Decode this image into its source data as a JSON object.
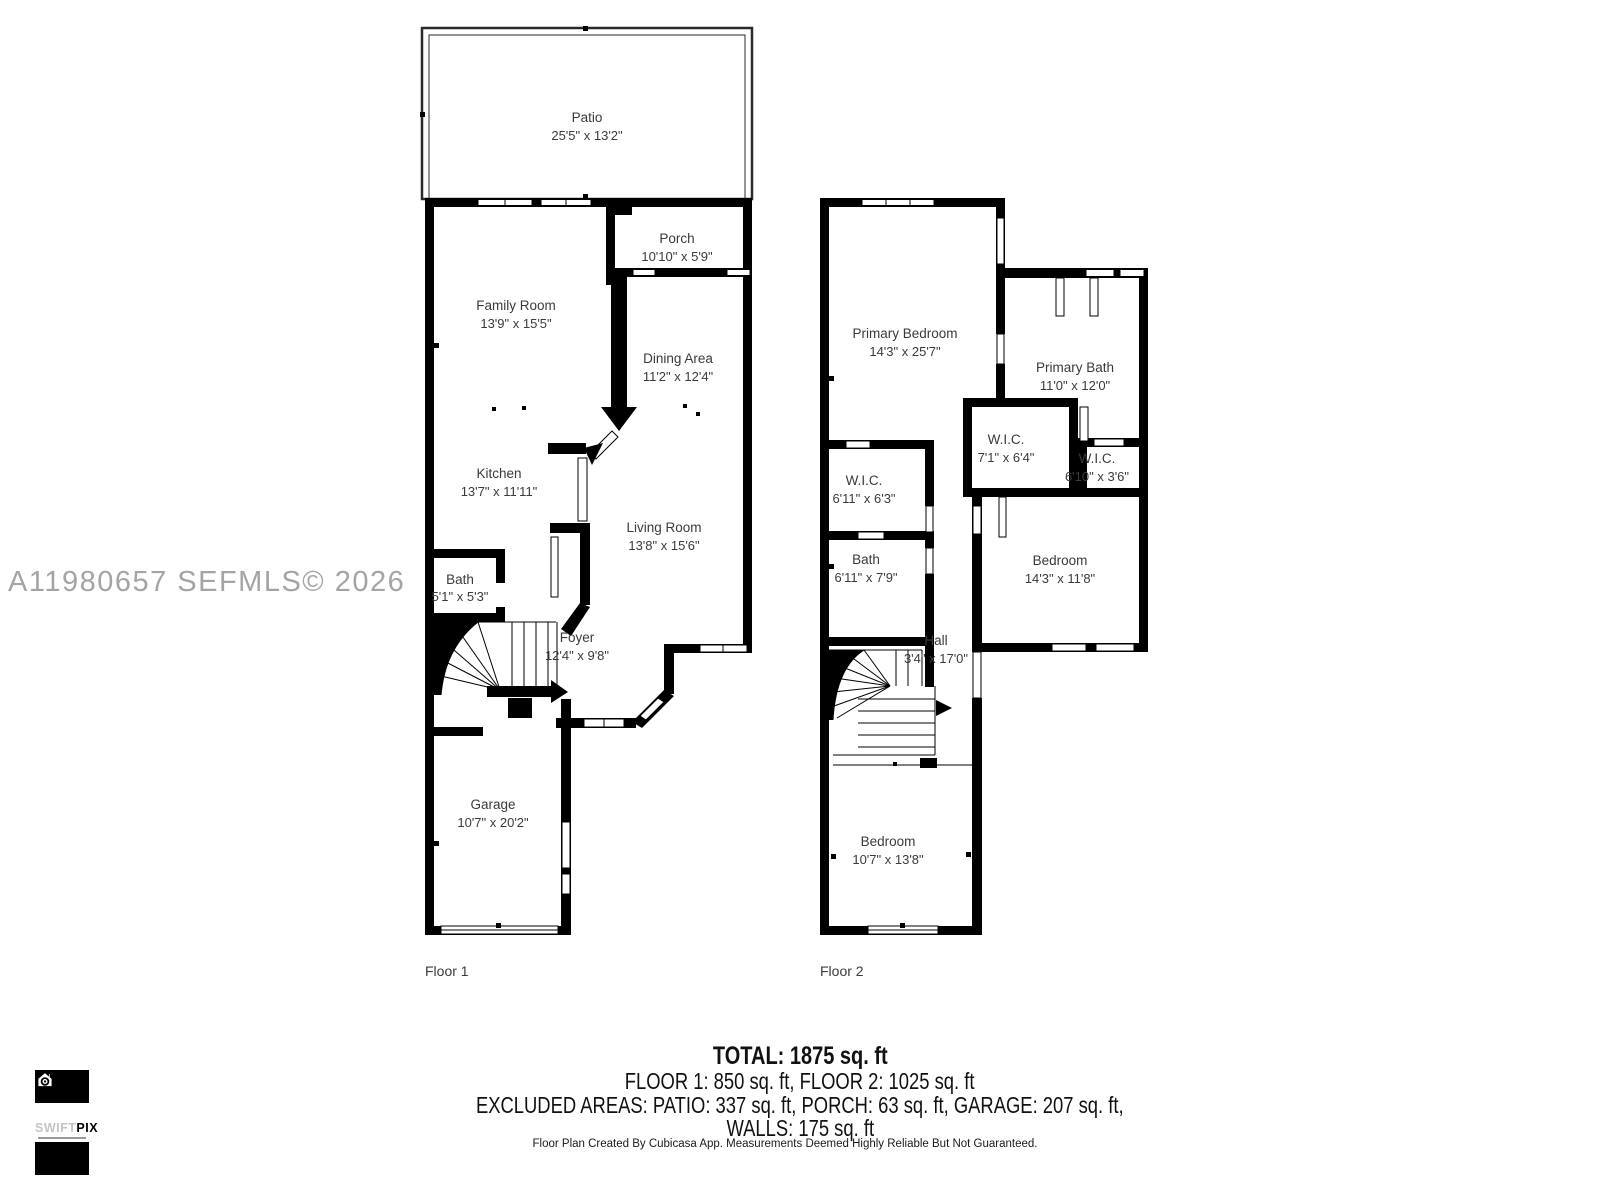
{
  "watermark": "A11980657  SEFMLS© 2026",
  "floor1": {
    "label": "Floor 1",
    "rooms": [
      {
        "name": "Patio",
        "dims": "25'5\" x 13'2\""
      },
      {
        "name": "Porch",
        "dims": "10'10\" x 5'9\""
      },
      {
        "name": "Family Room",
        "dims": "13'9\" x 15'5\""
      },
      {
        "name": "Dining Area",
        "dims": "11'2\" x 12'4\""
      },
      {
        "name": "Kitchen",
        "dims": "13'7\" x 11'11\""
      },
      {
        "name": "Living Room",
        "dims": "13'8\" x 15'6\""
      },
      {
        "name": "Bath",
        "dims": "5'1\" x 5'3\""
      },
      {
        "name": "Foyer",
        "dims": "12'4\" x 9'8\""
      },
      {
        "name": "Garage",
        "dims": "10'7\" x 20'2\""
      }
    ]
  },
  "floor2": {
    "label": "Floor 2",
    "rooms": [
      {
        "name": "Primary Bedroom",
        "dims": "14'3\" x 25'7\""
      },
      {
        "name": "Primary Bath",
        "dims": "11'0\" x 12'0\""
      },
      {
        "name": "W.I.C.",
        "dims": "7'1\" x 6'4\""
      },
      {
        "name": "W.I.C.",
        "dims": "6'10\" x 3'6\""
      },
      {
        "name": "W.I.C.",
        "dims": "6'11\" x 6'3\""
      },
      {
        "name": "Bath",
        "dims": "6'11\" x 7'9\""
      },
      {
        "name": "Bedroom",
        "dims": "14'3\" x 11'8\""
      },
      {
        "name": "Hall",
        "dims": "3'4\" x 17'0\""
      },
      {
        "name": "Bedroom",
        "dims": "10'7\" x 13'8\""
      }
    ]
  },
  "summary": {
    "total": "TOTAL: 1875 sq. ft",
    "floors": "FLOOR 1: 850 sq. ft, FLOOR 2: 1025 sq. ft",
    "excluded": "EXCLUDED AREAS: PATIO: 337 sq. ft, PORCH: 63 sq. ft, GARAGE: 207 sq. ft,",
    "walls": "WALLS: 175 sq. ft"
  },
  "footer": "Floor Plan Created By Cubicasa App. Measurements Deemed Highly Reliable But Not Guaranteed.",
  "logo": {
    "brand_light": "SWIFT",
    "brand_bold": "PIX"
  }
}
